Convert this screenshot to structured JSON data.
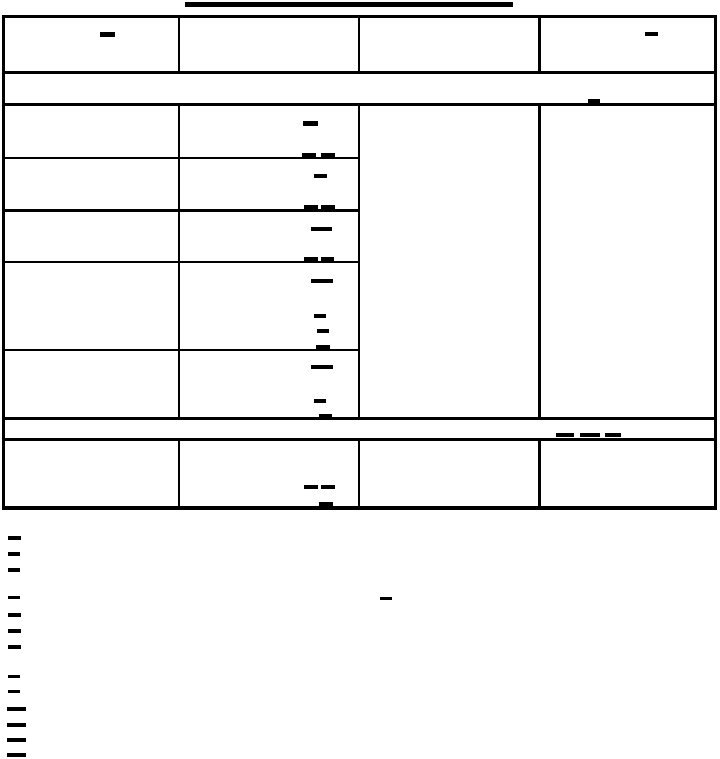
{
  "colors": {
    "ink": "#000000",
    "paper": "#ffffff"
  },
  "title": {
    "visible_text": "",
    "underline_present": true,
    "note": "title text did not render; only its underline is visible"
  },
  "table": {
    "columns": 4,
    "header_row": {
      "cells": [
        "-",
        "",
        "",
        "-"
      ]
    },
    "spanning_band_1": {
      "text": "",
      "visible_glyphs": [
        "_"
      ]
    },
    "body": {
      "col1_rows": [
        "",
        "",
        "",
        "",
        ""
      ],
      "col2_rows": [
        "- _ _",
        "- _ _",
        "- _ _",
        "- - - _",
        "- - _"
      ],
      "col3_merged_cell": "",
      "col4_merged_cell": ""
    },
    "spanning_band_2": {
      "text": "",
      "visible_glyphs": [
        "_",
        "_",
        "_"
      ]
    },
    "last_row": {
      "cells": [
        "",
        "- - _",
        "",
        ""
      ]
    }
  },
  "footnotes": {
    "visible_text": "",
    "line_lead_glyphs": [
      "-",
      "-",
      "-",
      "-",
      "-",
      "-",
      "-",
      "-",
      "-",
      "--",
      "--",
      "--",
      "--"
    ],
    "inline_glyph": "-"
  },
  "marks": {
    "header": [
      {
        "x": 100,
        "y": 32,
        "w": 15,
        "h": 5,
        "glyph": "-"
      },
      {
        "x": 645,
        "y": 32,
        "w": 13,
        "h": 4,
        "glyph": "-"
      }
    ],
    "separator1": [
      {
        "x": 588,
        "y": 99,
        "w": 12,
        "h": 4,
        "glyph": "_"
      }
    ],
    "body": [
      {
        "x": 303,
        "y": 121,
        "w": 15,
        "h": 5,
        "glyph": "-"
      },
      {
        "x": 302,
        "y": 153,
        "w": 14,
        "h": 4,
        "glyph": "_"
      },
      {
        "x": 321,
        "y": 153,
        "w": 14,
        "h": 4,
        "glyph": "_"
      },
      {
        "x": 314,
        "y": 174,
        "w": 13,
        "h": 4,
        "glyph": "-"
      },
      {
        "x": 304,
        "y": 205,
        "w": 14,
        "h": 4,
        "glyph": "_"
      },
      {
        "x": 321,
        "y": 205,
        "w": 14,
        "h": 4,
        "glyph": "_"
      },
      {
        "x": 311,
        "y": 227,
        "w": 21,
        "h": 4,
        "glyph": "-"
      },
      {
        "x": 304,
        "y": 257,
        "w": 14,
        "h": 4,
        "glyph": "_"
      },
      {
        "x": 321,
        "y": 257,
        "w": 13,
        "h": 4,
        "glyph": "_"
      },
      {
        "x": 311,
        "y": 279,
        "w": 22,
        "h": 4,
        "glyph": "-"
      },
      {
        "x": 314,
        "y": 314,
        "w": 12,
        "h": 4,
        "glyph": "-"
      },
      {
        "x": 317,
        "y": 329,
        "w": 12,
        "h": 4,
        "glyph": "-"
      },
      {
        "x": 316,
        "y": 345,
        "w": 14,
        "h": 4,
        "glyph": "_"
      },
      {
        "x": 311,
        "y": 365,
        "w": 22,
        "h": 4,
        "glyph": "-"
      },
      {
        "x": 314,
        "y": 399,
        "w": 12,
        "h": 4,
        "glyph": "-"
      },
      {
        "x": 319,
        "y": 414,
        "w": 13,
        "h": 4,
        "glyph": "_"
      }
    ],
    "separator2": [
      {
        "x": 556,
        "y": 433,
        "w": 18,
        "h": 4,
        "glyph": "_"
      },
      {
        "x": 580,
        "y": 433,
        "w": 20,
        "h": 4,
        "glyph": "_"
      },
      {
        "x": 605,
        "y": 433,
        "w": 16,
        "h": 4,
        "glyph": "_"
      }
    ],
    "last_row": [
      {
        "x": 304,
        "y": 485,
        "w": 14,
        "h": 4,
        "glyph": "-"
      },
      {
        "x": 321,
        "y": 485,
        "w": 14,
        "h": 4,
        "glyph": "-"
      },
      {
        "x": 319,
        "y": 502,
        "w": 14,
        "h": 4,
        "glyph": "_"
      }
    ],
    "footnotes": [
      {
        "x": 8,
        "y": 536,
        "w": 13,
        "h": 4,
        "glyph": "-"
      },
      {
        "x": 8,
        "y": 552,
        "w": 12,
        "h": 4,
        "glyph": "-"
      },
      {
        "x": 8,
        "y": 568,
        "w": 12,
        "h": 4,
        "glyph": "-"
      },
      {
        "x": 8,
        "y": 596,
        "w": 12,
        "h": 3,
        "glyph": "-"
      },
      {
        "x": 380,
        "y": 597,
        "w": 12,
        "h": 3,
        "glyph": "-"
      },
      {
        "x": 8,
        "y": 613,
        "w": 13,
        "h": 4,
        "glyph": "-"
      },
      {
        "x": 8,
        "y": 629,
        "w": 13,
        "h": 4,
        "glyph": "-"
      },
      {
        "x": 8,
        "y": 645,
        "w": 13,
        "h": 4,
        "glyph": "-"
      },
      {
        "x": 8,
        "y": 675,
        "w": 12,
        "h": 3,
        "glyph": "-"
      },
      {
        "x": 8,
        "y": 690,
        "w": 12,
        "h": 3,
        "glyph": "-"
      },
      {
        "x": 7,
        "y": 707,
        "w": 19,
        "h": 4,
        "glyph": "--"
      },
      {
        "x": 7,
        "y": 723,
        "w": 19,
        "h": 4,
        "glyph": "--"
      },
      {
        "x": 7,
        "y": 738,
        "w": 19,
        "h": 4,
        "glyph": "--"
      },
      {
        "x": 7,
        "y": 753,
        "w": 19,
        "h": 4,
        "glyph": "--"
      }
    ]
  }
}
